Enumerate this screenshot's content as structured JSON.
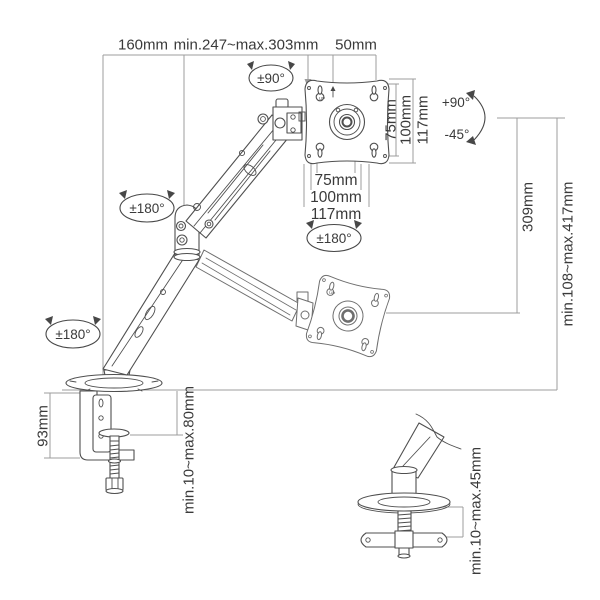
{
  "page": {
    "width": 600,
    "height": 600,
    "background": "#ffffff"
  },
  "colors": {
    "drawing_line": "#4f4f4f",
    "secondary_line": "#6e6e6e",
    "dimension_line": "#9c9c9c",
    "text": "#3a3a3a"
  },
  "dimensions": {
    "top_left_width": "160mm",
    "top_extension": "min.247~max.303mm",
    "top_head_width": "50mm",
    "vesa_vertical": [
      "75mm",
      "100mm",
      "117mm"
    ],
    "vesa_horizontal": [
      "75mm",
      "100mm",
      "117mm"
    ],
    "vertical_travel": "309mm",
    "height_range": "min.108~max.417mm",
    "clamp_height": "93mm",
    "clamp_desk_thickness": "min.10~max.80mm",
    "grommet_desk_thickness": "min.10~max.45mm"
  },
  "rotations": {
    "head_swivel": "±90°",
    "tilt_up": "+90°",
    "tilt_down": "-45°",
    "vesa_rotation": "±180°",
    "elbow_rotation": "±180°",
    "base_rotation": "±180°"
  },
  "markings": {
    "vesa_up": "UP"
  }
}
